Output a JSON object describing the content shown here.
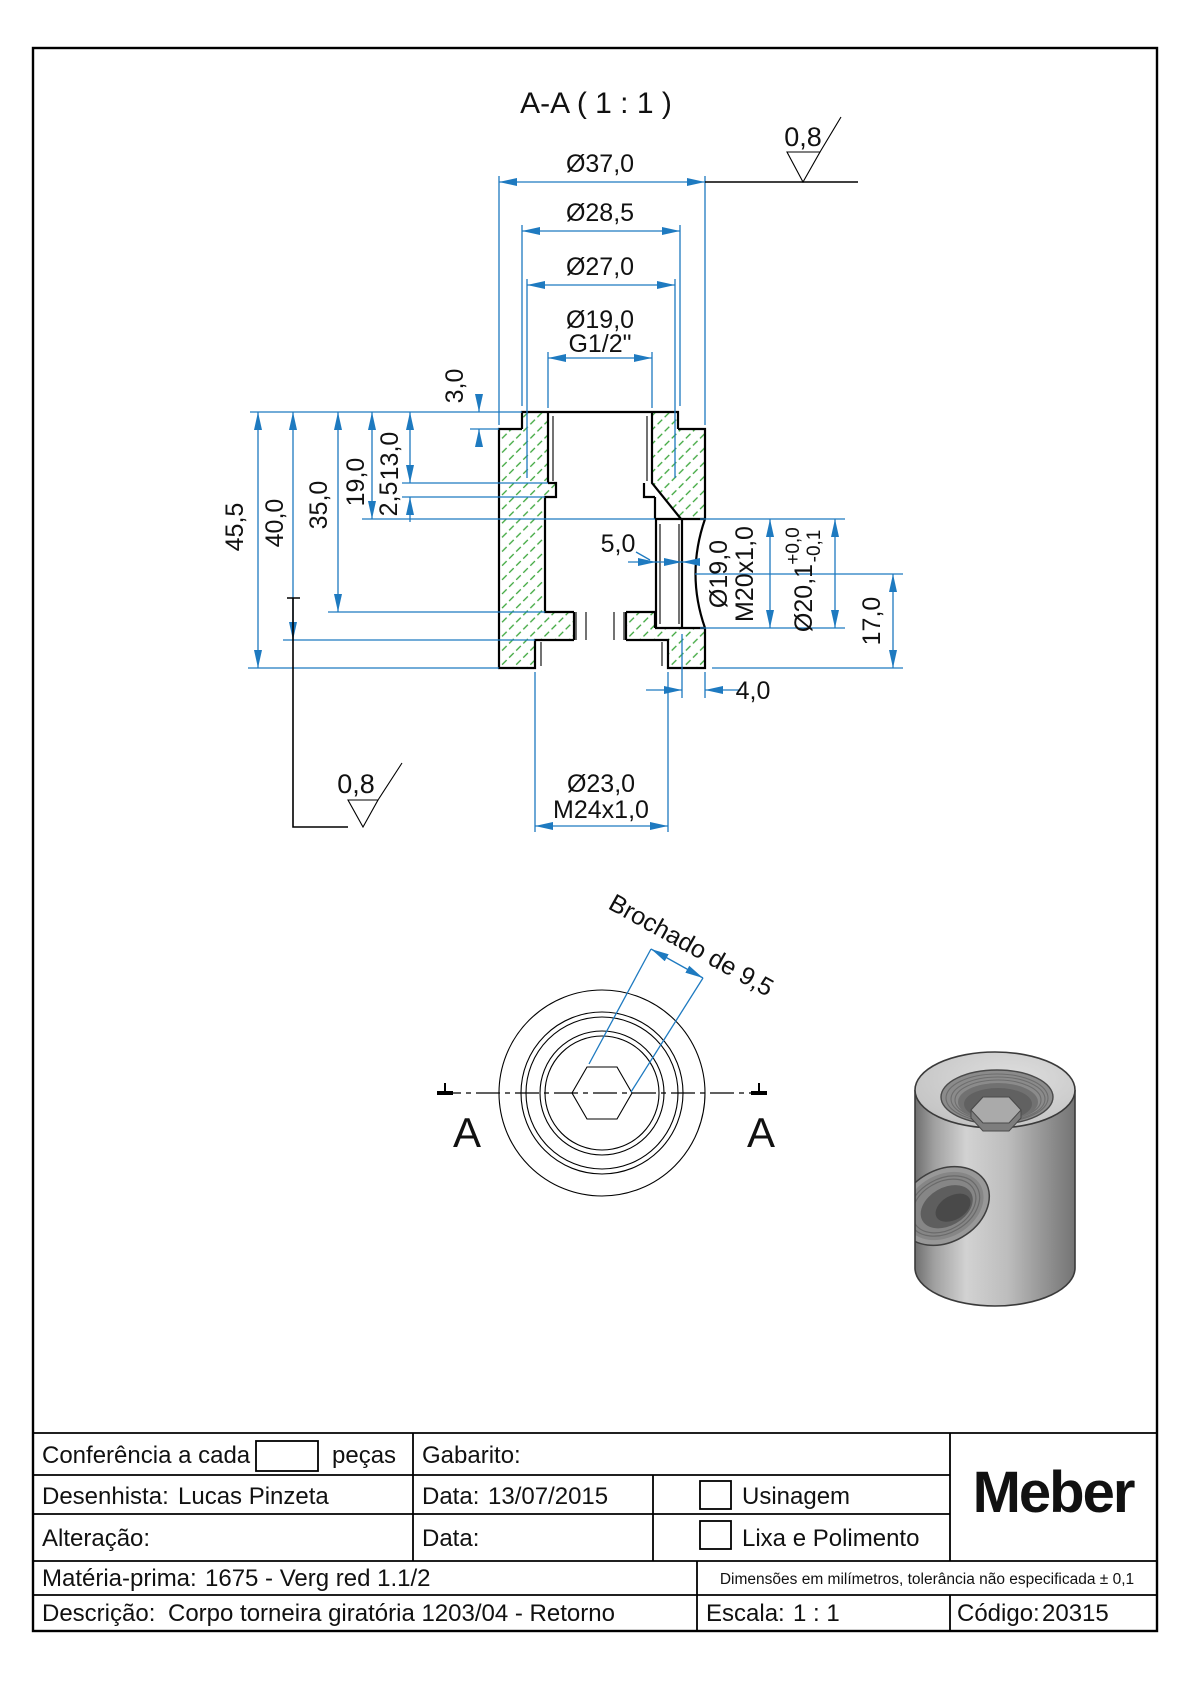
{
  "drawing": {
    "section_title": "A-A ( 1 : 1 )",
    "finish_top": "0,8",
    "finish_bottom": "0,8",
    "dims_top": {
      "d37": "Ø37,0",
      "d285": "Ø28,5",
      "d27": "Ø27,0",
      "d19": "Ø19,0",
      "g12": "G1/2\""
    },
    "dims_left": {
      "h455": "45,5",
      "h400": "40,0",
      "h350": "35,0",
      "h190": "19,0",
      "h130": "13,0",
      "h25": "2,5",
      "h30": "3,0"
    },
    "dims_right": {
      "d19": "Ø19,0",
      "m20": "M20x1,0",
      "d201": "Ø20,1",
      "tol_plus": "+0,0",
      "tol_minus": "-0,1",
      "h170": "17,0",
      "w40": "4,0",
      "w50": "5,0"
    },
    "dims_bottom": {
      "d23": "Ø23,0",
      "m24": "M24x1,0"
    },
    "bottom_view": {
      "label_left": "A",
      "label_right": "A",
      "broach_note": "Brochado de 9,5"
    },
    "colors": {
      "dimension": "#1e7ac0",
      "hatch": "#3aa53a",
      "outline": "#000000"
    }
  },
  "titleblock": {
    "conferencia_label": "Conferência a cada",
    "conferencia_suffix": "peças",
    "gabarito_label": "Gabarito:",
    "desenhista_label": "Desenhista:",
    "desenhista_value": "Lucas Pinzeta",
    "data1_label": "Data:",
    "data1_value": "13/07/2015",
    "alteracao_label": "Alteração:",
    "data2_label": "Data:",
    "usinagem_label": "Usinagem",
    "lixa_label": "Lixa e Polimento",
    "materia_label": "Matéria-prima:",
    "materia_value": "1675 - Verg red 1.1/2",
    "tolerancia_note": "Dimensões em milímetros, tolerância não especificada ± 0,1",
    "descricao_label": "Descrição:",
    "descricao_value": "Corpo torneira giratória 1203/04 - Retorno",
    "escala_label": "Escala:",
    "escala_value": "1 : 1",
    "codigo_label": "Código:",
    "codigo_value": "20315",
    "brand": "Meber"
  }
}
